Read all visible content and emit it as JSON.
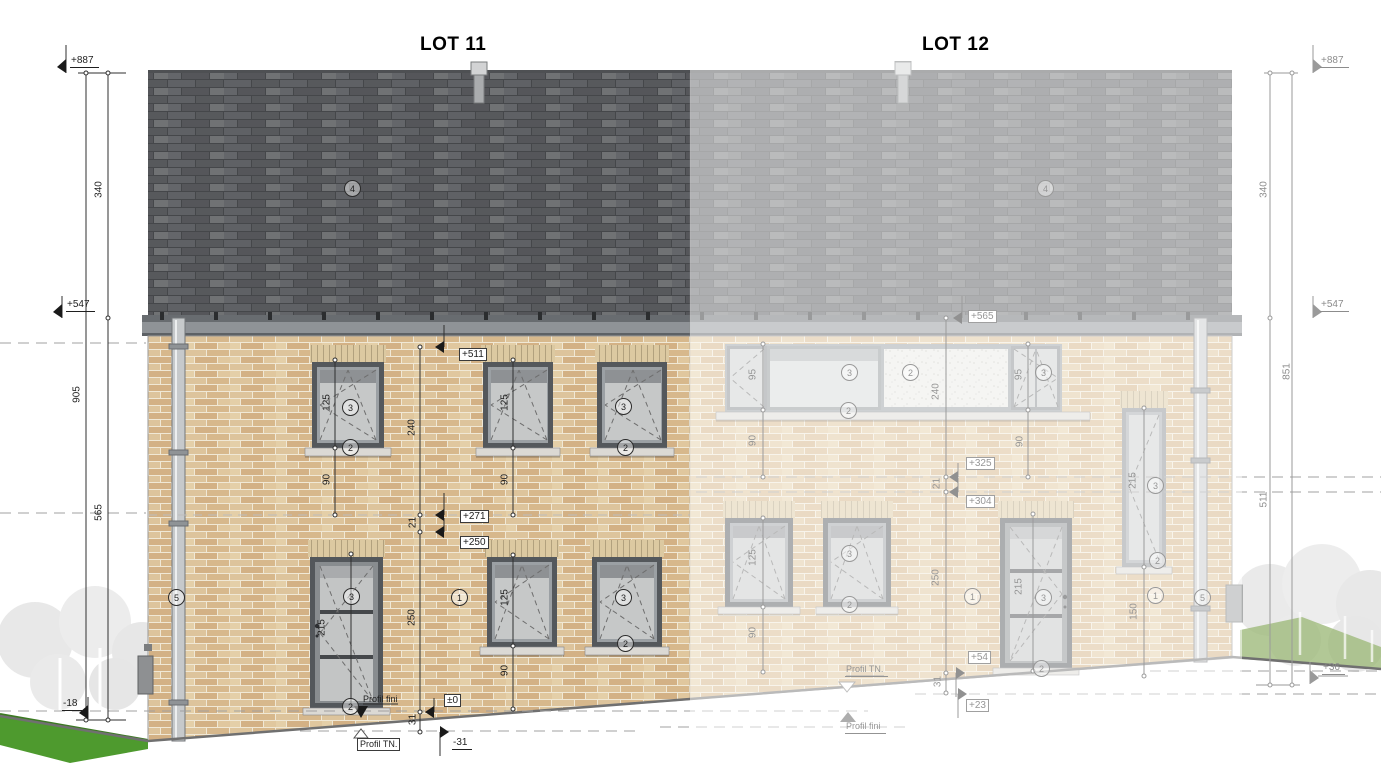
{
  "drawing": {
    "lot11": {
      "title": "LOT 11",
      "levels": {
        "l511": "+511",
        "l271": "+271",
        "l250": "+250",
        "l0": "±0",
        "lm31": "-31"
      },
      "runs": {
        "r240": "240",
        "r21": "21",
        "r250": "250",
        "r31": "31"
      },
      "openings": {
        "up_left_h": "125",
        "up_left_off": "90",
        "up_mid_h": "125",
        "up_mid_off": "90",
        "door_h": "215",
        "low_mid_h": "125",
        "low_mid_off": "90"
      },
      "profiles": {
        "tn": "Profil TN.",
        "fini": "Profil fini"
      }
    },
    "lot12": {
      "title": "LOT 12",
      "levels": {
        "l565": "+565",
        "l325": "+325",
        "l304": "+304",
        "l54": "+54",
        "l23": "+23"
      },
      "runs": {
        "r240": "240",
        "r21": "21",
        "r250": "250",
        "r31": "31"
      },
      "openings": {
        "band_left_h": "95",
        "band_left_off": "90",
        "band_right_h": "95",
        "band_right_off": "90",
        "low_left_h": "125",
        "low_left_off": "90",
        "door_h": "215",
        "tall_h": "215",
        "tall_off": "150"
      },
      "profiles": {
        "tn": "Profil TN.",
        "fini": "Profil fini"
      }
    },
    "left_column": {
      "elev_ridge": "+887",
      "roof_height": "340",
      "elev_eaves": "+547",
      "total_height": "905",
      "wall_height": "565",
      "elev_terrain": "-18"
    },
    "right_column": {
      "elev_ridge": "+887",
      "roof_height": "340",
      "elev_eaves": "+547",
      "total_height": "851",
      "wall_height": "511",
      "elev_terrain": "+36"
    },
    "material_refs": {
      "m1": "1",
      "m2": "2",
      "m3": "3",
      "m4": "4",
      "m5": "5"
    }
  }
}
